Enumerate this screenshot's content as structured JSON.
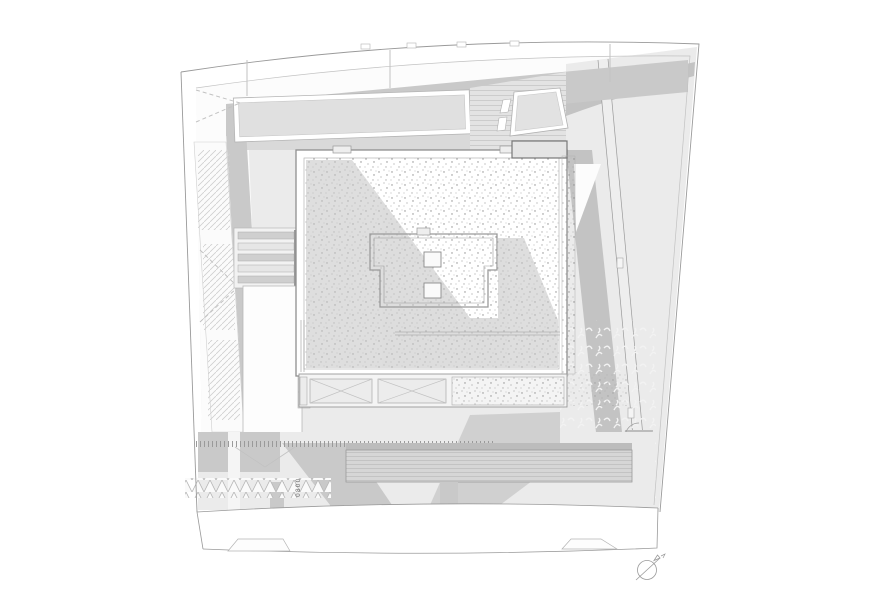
{
  "annotations": {
    "equipment_label": "0800"
  },
  "palette": {
    "paper": "#ffffff",
    "line": "#9a9a9a",
    "line_light": "#c2c2c2",
    "band": "#c9c9c9",
    "band_light": "#d9d9d9",
    "area_light": "#ebebeb",
    "shadow": "#c3c3c3",
    "dark_patch": "#bcbcbc",
    "dot": "#8f8f8f",
    "text": "#6e6e6e"
  }
}
